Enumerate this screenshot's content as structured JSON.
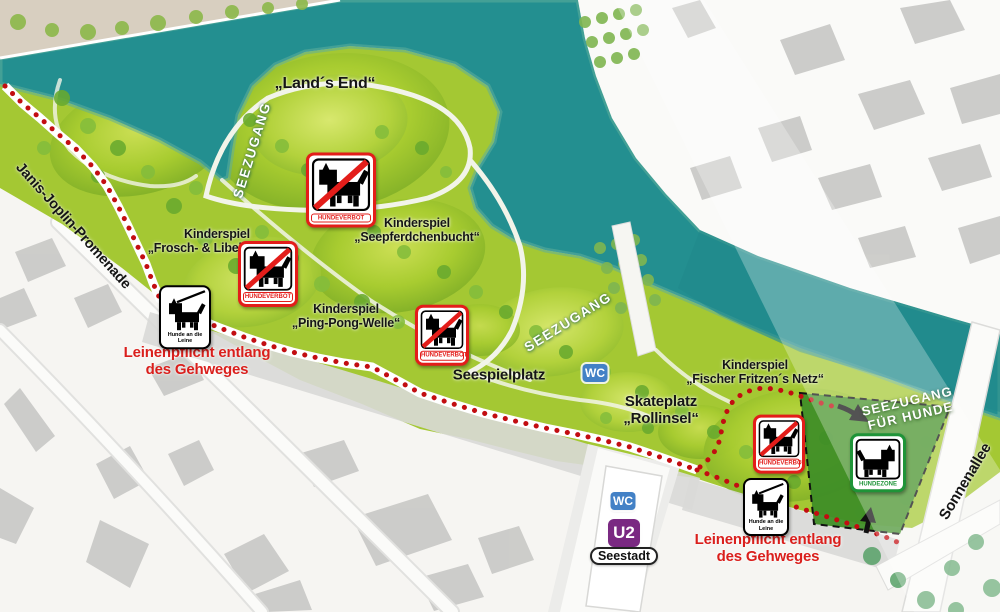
{
  "map": {
    "streets": {
      "janis_joplin": "Janis-Joplin-Promenade",
      "sonnenallee": "Sonnenallee"
    },
    "water_labels": {
      "seezugang": "SEEZUGANG",
      "seezugang_fuer_hunde": {
        "line1": "SEEZUGANG",
        "line2": "FÜR HUNDE"
      }
    },
    "areas": {
      "lands_end": "„Land´s End“",
      "seespielplatz": "Seespielplatz",
      "skateplatz": {
        "line1": "Skateplatz",
        "line2": "„Rollinsel“"
      }
    },
    "playgrounds": [
      {
        "kicker": "Kinderspiel",
        "name": "„Frosch- & Libellenaue“"
      },
      {
        "kicker": "Kinderspiel",
        "name": "„Seepferdchenbucht“"
      },
      {
        "kicker": "Kinderspiel",
        "name": "„Ping-Pong-Welle“"
      },
      {
        "kicker": "Kinderspiel",
        "name": "„Fischer Fritzen´s Netz“"
      }
    ],
    "notices": {
      "leash_rule": {
        "line1": "Leinenpflicht entlang",
        "line2": "des Gehweges"
      }
    },
    "signs": {
      "hundeverbot": "HUNDEVERBOT",
      "hundezone": "HUNDEZONE",
      "leash": {
        "line1": "Hunde",
        "line2": "an die Leine"
      }
    },
    "badges": {
      "wc": "WC",
      "u2": "U2",
      "station": "Seestadt"
    },
    "colors": {
      "water": "#238f90",
      "park": "#a4c833",
      "dog_zone": "#3f8e27",
      "path_dots": "#c20d11",
      "notice_red": "#da1f1c",
      "wc_blue": "#4381c6",
      "u2_purple": "#7a2982",
      "hundeverbot_red": "#e31d1a",
      "hundezone_green": "#1f9438"
    }
  }
}
